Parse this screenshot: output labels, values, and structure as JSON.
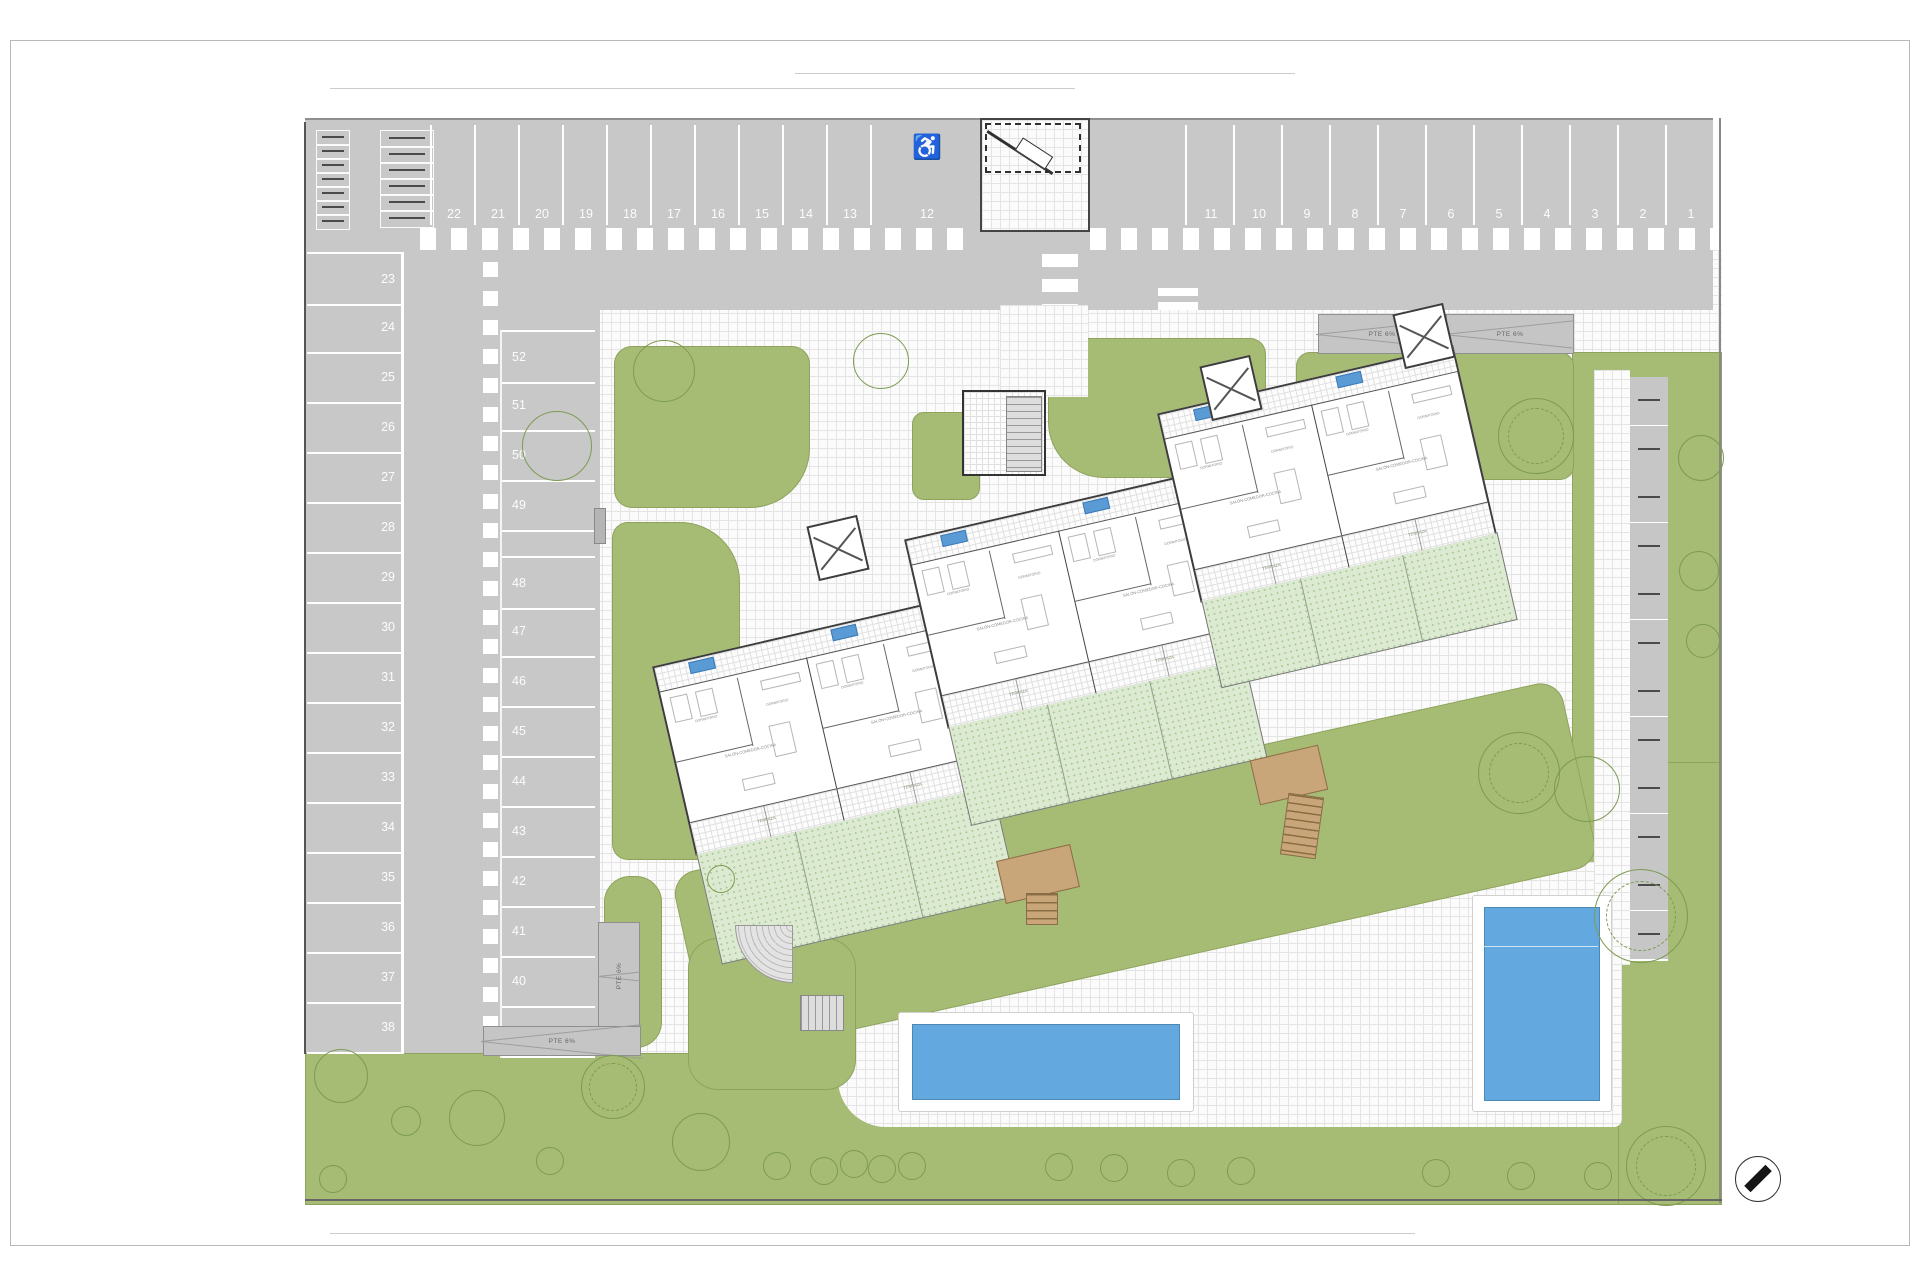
{
  "site": {
    "parking": {
      "top_left": [
        "22",
        "21",
        "20",
        "19",
        "18",
        "17",
        "16",
        "15",
        "14",
        "13"
      ],
      "handicap": "12",
      "top_right": [
        "11",
        "10",
        "9",
        "8",
        "7",
        "6",
        "5",
        "4",
        "3",
        "2",
        "1"
      ],
      "left_column": [
        "23",
        "24",
        "25",
        "26",
        "27",
        "28",
        "29",
        "30",
        "31",
        "32",
        "33",
        "34",
        "35",
        "36",
        "37",
        "38"
      ],
      "middle_column": [
        "52",
        "51",
        "50",
        "49",
        "48",
        "47",
        "46",
        "45",
        "44",
        "43",
        "42",
        "41",
        "40",
        "39"
      ]
    },
    "labels": {
      "ramp": "PTE 6%"
    },
    "rooms": {
      "living": "SALÓN-COMEDOR-COCINA",
      "bedroom": "DORMITORIO",
      "terrace": "TERRAZA"
    },
    "icons": {
      "handicap": "♿"
    },
    "units": 6,
    "colors": {
      "asphalt": "#c8c8c8",
      "grass": "#a6bb73",
      "private_garden": "#dcead2",
      "pool": "#63a9e0",
      "wood": "#c9a679",
      "tag": "#5b9bd5"
    }
  }
}
